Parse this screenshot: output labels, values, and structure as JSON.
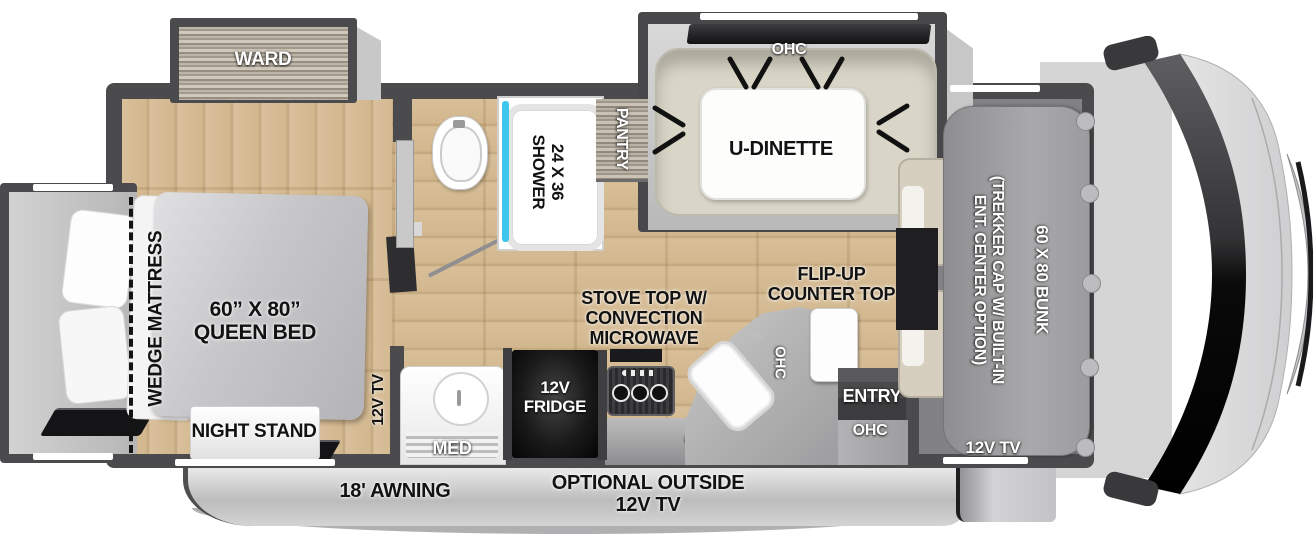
{
  "colors": {
    "wall": "#4b4b4d",
    "floor_wood": "#d6bd97",
    "slide_interior": "#c9c9c9",
    "dinette_sofa": "#d9d5c7",
    "shower_glass": "#3fc6ec",
    "fridge_black": "#0d0d0d",
    "awning_gray": "#c6c6c7",
    "bunk_gray": "#9b9b9d"
  },
  "slides": {
    "ward": {
      "label": "WARD"
    },
    "dinette": {
      "ohc": "OHC",
      "table": "U-DINETTE"
    }
  },
  "bedroom": {
    "wedge": "WEDGE MATTRESS",
    "bed_line1": "60” X 80”",
    "bed_line2": "QUEEN BED",
    "night_stand": "NIGHT STAND",
    "tv": "12V TV"
  },
  "bath": {
    "shower_line1": "24 X 36",
    "shower_line2": "SHOWER",
    "pantry": "PANTRY",
    "med": "MED"
  },
  "kitchen": {
    "fridge_line1": "12V",
    "fridge_line2": "FRIDGE",
    "stove_line1": "STOVE TOP W/",
    "stove_line2": "CONVECTION",
    "stove_line3": "MICROWAVE",
    "flip_line1": "FLIP-UP",
    "flip_line2": "COUNTER TOP",
    "ohc_counter": "OHC",
    "ohc_lower": "OHC",
    "entry": "ENTRY",
    "ohc_entry": "OHC"
  },
  "front": {
    "bunk": "60 X 80 BUNK",
    "option_line1": "(TREKKER CAP W/ BUILT-IN",
    "option_line2": "ENT. CENTER OPTION)",
    "tv": "12V TV"
  },
  "exterior": {
    "awning": "18' AWNING",
    "outside_tv_line1": "OPTIONAL OUTSIDE",
    "outside_tv_line2": "12V TV"
  }
}
